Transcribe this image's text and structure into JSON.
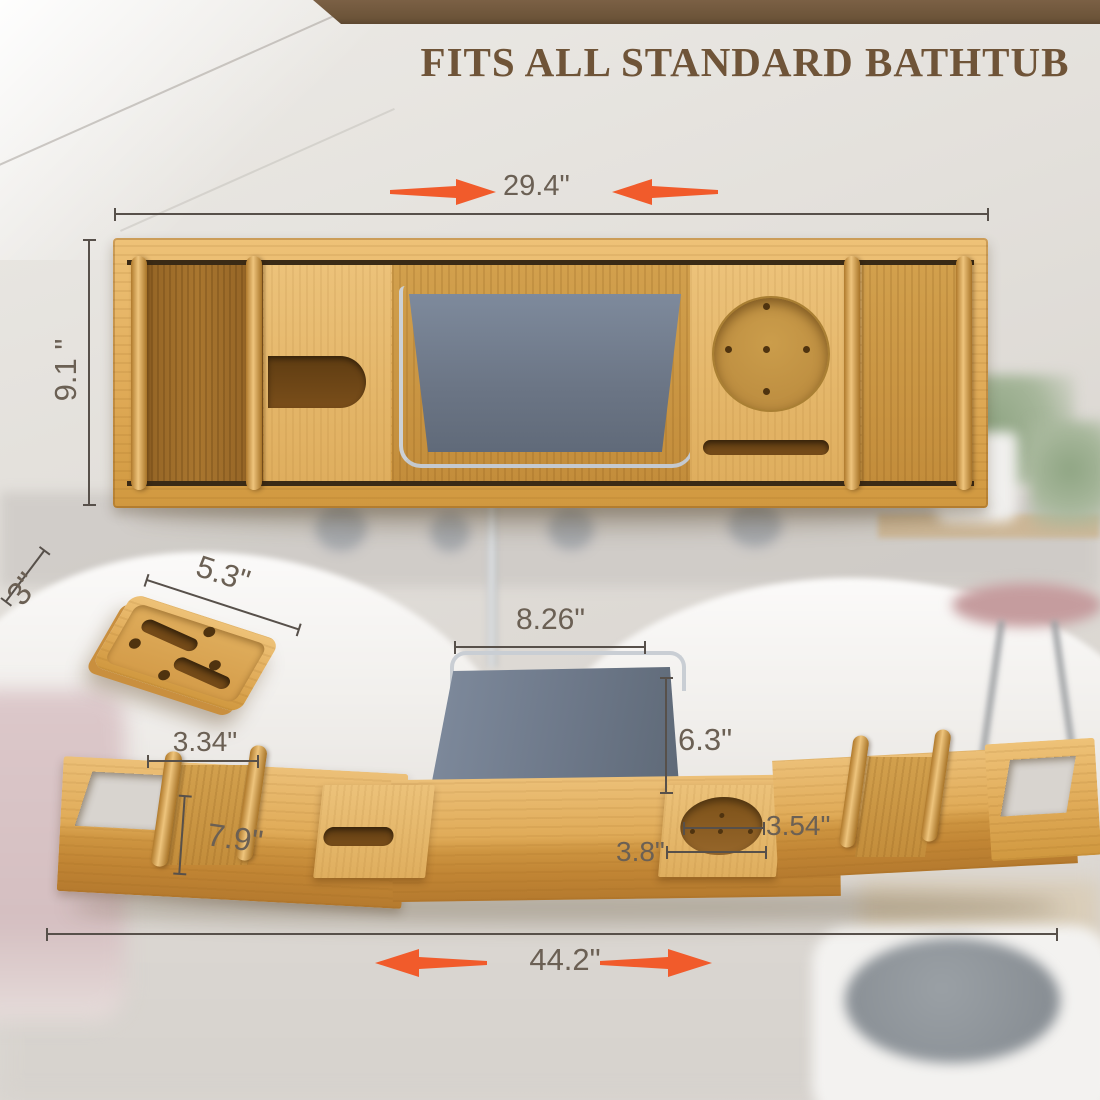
{
  "banner": {
    "title": "FITS ALL STANDARD BATHTUB"
  },
  "dimensions": {
    "tray_closed_width": "29.4\"",
    "tray_depth": "9.1 \"",
    "soap_tray_depth": "3\"",
    "soap_tray_width": "5.3\"",
    "book_stand_width": "8.26\"",
    "book_stand_height": "6.3\"",
    "rail_spacing": "3.34\"",
    "left_tray_width": "7.9\"",
    "cup_holder_width": "3.54\"",
    "cup_slot_width": "3.8\"",
    "tray_extended_width": "44.2\""
  },
  "colors": {
    "arrow_accent": "#F15B2B",
    "banner_brown": "#6C5439",
    "title_brown": "#6F5438",
    "bamboo_light": "#E5B568",
    "bamboo_dark": "#C68E3A",
    "stand_gray": "#6D7889",
    "dimension_line": "#57504A",
    "dimension_text": "#6B6054"
  }
}
